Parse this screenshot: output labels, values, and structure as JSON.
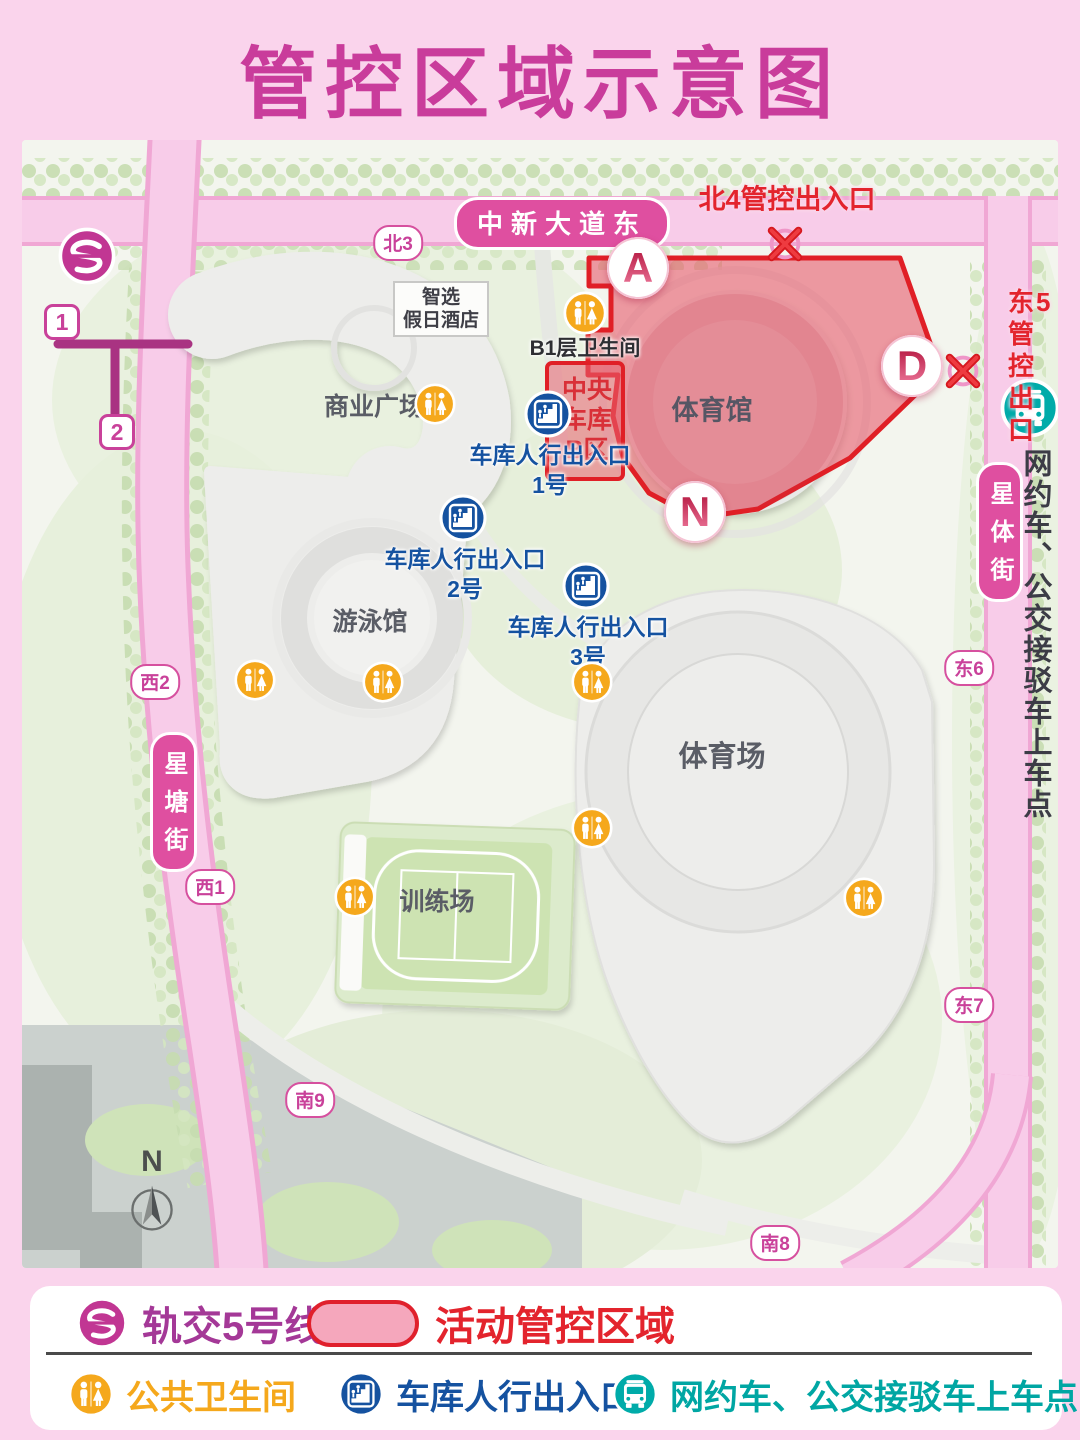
{
  "title": "管控区域示意图",
  "colors": {
    "frame_pink": "#FAD4EC",
    "title_magenta": "#C93C9B",
    "road_pink": "#F8CCE9",
    "street_pill_magenta": "#DF4FA0",
    "zone_border_red": "#E01F26",
    "zone_fill_pink": "#ED8B99",
    "control_text_red": "#E3242D",
    "garage_blue": "#1552A0",
    "restroom_orange": "#F5A81C",
    "bus_teal": "#00ABA9",
    "rail_magenta": "#A43897"
  },
  "map": {
    "main_road": "中新大道东",
    "street_left": "星塘街",
    "street_right": "星体街",
    "road_markers": [
      "北3",
      "西2",
      "西1",
      "南9",
      "南8",
      "东6",
      "东7"
    ],
    "metro_exits": [
      "1",
      "2"
    ],
    "north_gate": "北4管控出入口",
    "east_exit": "东5\n管控\n出口",
    "gates": [
      "A",
      "D",
      "N"
    ],
    "pickup_vertical": "网约车、公交接驳车上车点",
    "hotel": "智选\n假日酒店",
    "b1_restroom": "B1层卫生间",
    "central_garage": "中央\n车库\nB区",
    "buildings": {
      "plaza": "商业广场",
      "gym": "体育馆",
      "pool": "游泳馆",
      "stadium": "体育场",
      "training": "训练场"
    },
    "garage_entrances": [
      "车库人行出入口\n1号",
      "车库人行出入口\n2号",
      "车库人行出入口\n3号"
    ],
    "compass": "N"
  },
  "legend": {
    "rail": "轨交5号线",
    "zone": "活动管控区域",
    "restroom": "公共卫生间",
    "garage": "车库人行出入口",
    "pickup": "网约车、公交接驳车上车点"
  }
}
